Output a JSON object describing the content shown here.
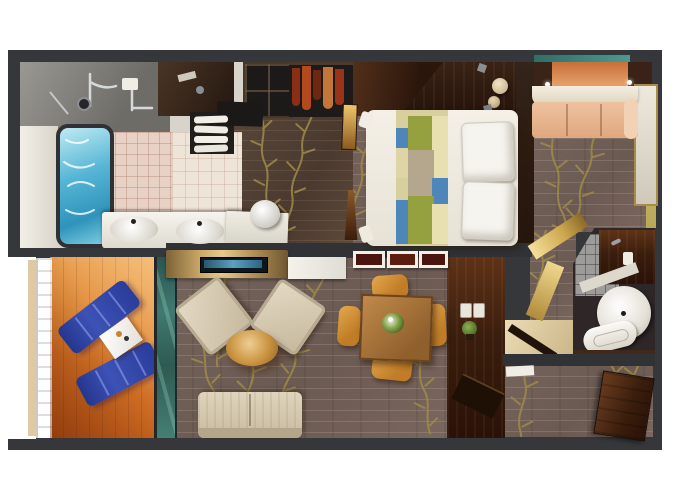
{
  "scene": {
    "description": "Top-down 3D rendered floor plan of a two-bedroom suite with balcony (no visible text in image)",
    "canvas": {
      "width": 680,
      "height": 486
    },
    "background": "#ffffff",
    "no_visible_text": true
  },
  "palette": {
    "walls": "#35373a",
    "carpet": "#6f5e56",
    "carpet_gold_vine": "#a08a48",
    "balcony_deck_wood": "#d2762c",
    "lounger_blue": "#2e3f9f",
    "whirlpool_water": "#45a8cc",
    "bathroom_tile_pink": "#e8d2c5",
    "bed_linen_white": "#f2eee5",
    "bed_runner_olive": "#95a03f",
    "bed_runner_blue": "#4e86ba",
    "bed_runner_cream": "#e9e0b2",
    "credenza_gold": "#c9a25c",
    "tv_screen_blue": "#5ba0c0",
    "armchair_beige": "#d9cdb5",
    "dining_table_wood": "#b5854a",
    "dining_chair_amber": "#d39139",
    "dark_mahogany": "#45250f",
    "sofa_bed_peach": "#e7b894",
    "glass_partition_teal": "#3f7a70",
    "vestibule_marble": "#dcc795",
    "wardrobe_clothes_red": "#b34a1c"
  },
  "rooms": [
    {
      "id": "master-bathroom",
      "label": "Master bathroom",
      "furniture": [
        "shower with chrome fixtures",
        "whirlpool tub with blue water",
        "double-sink vanity",
        "towel shelf",
        "round vanity stool",
        "pink wall tiles"
      ]
    },
    {
      "id": "walk-in-closet",
      "label": "Walk-in closet / dressing area",
      "furniture": [
        "open shelving cubbies",
        "hanging clothes in red and orange",
        "bronze full-length mirror",
        "storage bench",
        "white makeup desk"
      ]
    },
    {
      "id": "master-bedroom",
      "label": "Master bedroom",
      "furniture": [
        "bed with white duvet and geometric runner",
        "two white pillows",
        "dark headboard wall",
        "dresser top with round lamps"
      ]
    },
    {
      "id": "living-room",
      "label": "Living room",
      "furniture": [
        "gold TV credenza",
        "wet-bar counter",
        "two beige armchairs",
        "round wood ottoman",
        "beige sofa",
        "three framed wall pictures"
      ]
    },
    {
      "id": "dining-area",
      "label": "Dining area",
      "furniture": [
        "square wood dining table",
        "four amber chairs",
        "green floral centerpiece",
        "dark mahogany desk wall with switches and plant"
      ]
    },
    {
      "id": "balcony",
      "label": "Private balcony",
      "furniture": [
        "two blue sun loungers",
        "white side table with drinks",
        "white railing",
        "orange wood decking",
        "teal glass partition"
      ]
    },
    {
      "id": "second-bedroom",
      "label": "Second bedroom",
      "furniture": [
        "peach double sofa bed",
        "wall mirror panel",
        "ceiling downlights",
        "gold lit alcove walls"
      ]
    },
    {
      "id": "second-bathroom",
      "label": "Second bathroom",
      "furniture": [
        "round white basin",
        "toilet",
        "dark vanity counter",
        "gray tiled floor"
      ]
    },
    {
      "id": "entry",
      "label": "Entry hall",
      "furniture": [
        "open entrance door",
        "marble vestibule with swing door",
        "white door mat",
        "luggage bench"
      ]
    }
  ]
}
